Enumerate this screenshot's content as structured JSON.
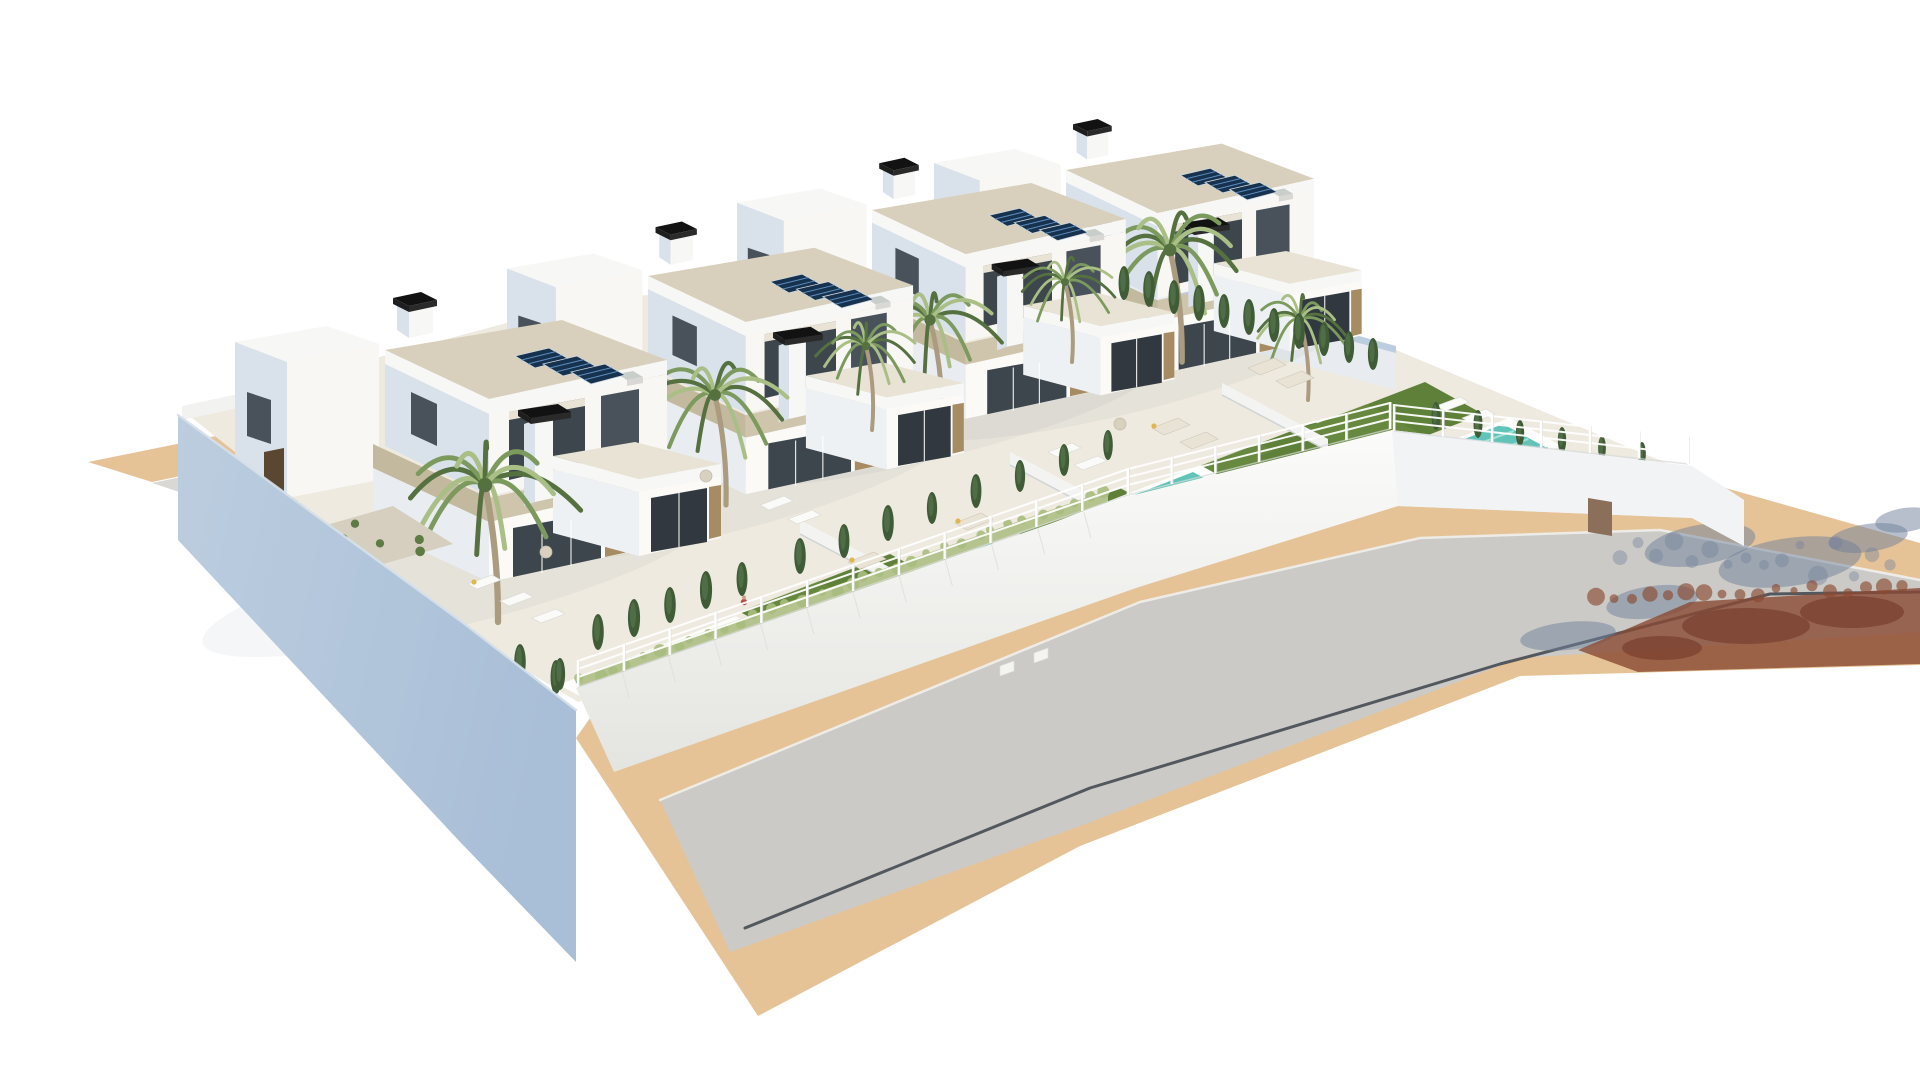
{
  "image": {
    "type": "3d-architectural-render",
    "subject": "Aerial 3D rendering of a row of four modern white two-storey villas with travertine accents, rooftop solar panels, black chimney caps, palm trees, private turquoise pools, green lawns, white perimeter walls with railing fences, and a curving grey road with sand-coloured sidewalks on a pure white background",
    "background": "#ffffff"
  },
  "palette": {
    "white_face": "#f8f7f4",
    "white_face2": "#fbfaf7",
    "face_shadow": "#d9e1eb",
    "face_shadow2": "#e9edf2",
    "face_soft": "#eef1f4",
    "roof_deck": "#d8d0bc",
    "roof_deck2": "#e8e3d5",
    "fascia": "#f7f7f5",
    "stone": "#cfc5ac",
    "stone_dark": "#c3b99f",
    "glass": "#3d454d",
    "glass_dark": "#31383f",
    "glass_win": "#49525b",
    "wood": "#a78c63",
    "wood_dark": "#5a4631",
    "solar": "#16324f",
    "solar_line": "#5d8cbd",
    "chimney": "#121212",
    "chimney_s1": "#1e1e1e",
    "chimney_s2": "#2a2a2a",
    "pool_water": "#62c4b8",
    "pool_light": "#aee8de",
    "pool_deep": "#37968c",
    "coping": "#fdfdfb",
    "lawn": "#5e8038",
    "lawn_light": "#739449",
    "palm_dark": "#55713f",
    "palm_mid": "#7c9a5e",
    "palm_light": "#a9bf85",
    "trunk": "#ab9c80",
    "cypress": "#3f5c37",
    "cypress_light": "#54734a",
    "hedge": "#b5c48e",
    "hedge_dot": "#a9bd7e",
    "shrub": "#5d7c44",
    "plot": "#efeae0",
    "gravel": "#d6cfc0",
    "road": "#cbcac7",
    "pavement": "#e5c397",
    "sidewalk_gray": "#d9d8d4",
    "driveway": "#5f6f88",
    "curb_brown": "#8f5138",
    "wall_blue": "#a9bfd7",
    "wall_blue_light": "#bccddf",
    "wall_inner": "#e8ecf0",
    "wall_white": "#f2f3f1",
    "wall_right": "#f1f3f5",
    "slate_shadow": "#70809a",
    "red_shadow": "#8a4a33",
    "red_shadow_dark": "#6f3424",
    "curb_line": "#3e444b",
    "fence": "#ffffff",
    "fence_shade": "#d7dadc",
    "ac_unit": "#c9cecb",
    "furn": "#e9e3d5",
    "furn_white": "#fafaf8",
    "pillow": "#e0b64f",
    "person_body": "#b05046",
    "person_skin": "#caa08a",
    "slat_fence": "#44352a",
    "slat_line": "#5d4936",
    "table": "#d8d1c0"
  },
  "scene": {
    "ground": {
      "tan_strip": [
        [
          88,
          462
        ],
        [
          640,
          350
        ],
        [
          708,
          366
        ],
        [
          152,
          482
        ]
      ],
      "gray_strip": [
        [
          152,
          483
        ],
        [
          708,
          367
        ],
        [
          764,
          384
        ],
        [
          210,
          502
        ]
      ],
      "driveway": [
        [
          210,
          503
        ],
        [
          432,
          457
        ],
        [
          500,
          492
        ],
        [
          274,
          541
        ]
      ],
      "brown_strip": [
        [
          274,
          542
        ],
        [
          500,
          493
        ],
        [
          524,
          507
        ],
        [
          297,
          557
        ]
      ],
      "pavement": [
        [
          590,
          718
        ],
        [
          1130,
          528
        ],
        [
          1392,
          458
        ],
        [
          1690,
          478
        ],
        [
          1920,
          543
        ],
        [
          1920,
          665
        ],
        [
          1520,
          676
        ],
        [
          1080,
          846
        ],
        [
          758,
          1016
        ],
        [
          576,
          738
        ]
      ],
      "road": [
        [
          660,
          800
        ],
        [
          1140,
          602
        ],
        [
          1420,
          538
        ],
        [
          1660,
          530
        ],
        [
          1920,
          580
        ],
        [
          1920,
          632
        ],
        [
          1520,
          658
        ],
        [
          1080,
          826
        ],
        [
          730,
          952
        ]
      ],
      "plot": [
        [
          182,
          410
        ],
        [
          600,
          298
        ],
        [
          1100,
          268
        ],
        [
          1396,
          350
        ],
        [
          1700,
          477
        ],
        [
          1692,
          502
        ],
        [
          1392,
          452
        ],
        [
          1130,
          512
        ],
        [
          578,
          702
        ],
        [
          462,
          632
        ]
      ],
      "back_wall": [
        [
          1098,
          266
        ],
        [
          1396,
          346
        ],
        [
          1396,
          390
        ],
        [
          1098,
          310
        ]
      ],
      "back_wall_cap": [
        [
          1098,
          266
        ],
        [
          1396,
          346
        ],
        [
          1396,
          353
        ],
        [
          1098,
          273
        ]
      ],
      "left_small_wall": [
        [
          182,
          406
        ],
        [
          266,
          388
        ],
        [
          266,
          402
        ],
        [
          182,
          420
        ]
      ],
      "slat_fence": [
        [
          240,
          386
        ],
        [
          334,
          364
        ],
        [
          350,
          377
        ],
        [
          256,
          399
        ]
      ],
      "front_wall": [
        [
          576,
          688
        ],
        [
          1130,
          496
        ],
        [
          1392,
          430
        ],
        [
          1692,
          466
        ],
        [
          1744,
          500
        ],
        [
          1744,
          546
        ],
        [
          1692,
          518
        ],
        [
          1398,
          506
        ],
        [
          1136,
          588
        ],
        [
          614,
          772
        ]
      ],
      "right_wall_face": [
        [
          1392,
          430
        ],
        [
          1692,
          466
        ],
        [
          1744,
          500
        ],
        [
          1744,
          546
        ],
        [
          1692,
          518
        ],
        [
          1398,
          506
        ]
      ],
      "hedge": [
        [
          578,
          676
        ],
        [
          1108,
          490
        ],
        [
          1108,
          502
        ],
        [
          578,
          690
        ]
      ],
      "left_wall": [
        [
          178,
          415
        ],
        [
          462,
          622
        ],
        [
          576,
          710
        ],
        [
          576,
          962
        ],
        [
          462,
          844
        ],
        [
          178,
          540
        ]
      ],
      "wall_door": [
        [
          1588,
          498
        ],
        [
          1612,
          502
        ],
        [
          1612,
          536
        ],
        [
          1588,
          532
        ]
      ],
      "curb_line": [
        [
          745,
          928
        ],
        [
          1090,
          788
        ],
        [
          1500,
          664
        ],
        [
          1770,
          594
        ],
        [
          1920,
          592
        ]
      ],
      "road_top_line": [
        [
          660,
          800
        ],
        [
          1140,
          602
        ],
        [
          1420,
          538
        ],
        [
          1660,
          530
        ],
        [
          1920,
          580
        ]
      ]
    },
    "shadows": {
      "slate": [
        [
          1700,
          545,
          56,
          20,
          -10
        ],
        [
          1790,
          562,
          72,
          24,
          -8
        ],
        [
          1652,
          602,
          46,
          16,
          -8
        ],
        [
          1868,
          538,
          40,
          14,
          -8
        ],
        [
          1568,
          636,
          48,
          14,
          -6
        ],
        [
          1905,
          520,
          30,
          12,
          -8
        ]
      ],
      "red_polygon": [
        [
          1578,
          650
        ],
        [
          1690,
          602
        ],
        [
          1788,
          596
        ],
        [
          1920,
          588
        ],
        [
          1920,
          664
        ],
        [
          1638,
          672
        ]
      ],
      "red_blobs": [
        [
          1746,
          626,
          64,
          18
        ],
        [
          1852,
          612,
          52,
          16
        ],
        [
          1662,
          648,
          40,
          12
        ]
      ]
    },
    "fence": {
      "segments": [
        [
          [
            578,
            686
          ],
          [
            1128,
            494
          ]
        ],
        [
          [
            1128,
            494
          ],
          [
            1390,
            428
          ]
        ],
        [
          [
            1394,
            430
          ],
          [
            1688,
            463
          ]
        ]
      ],
      "post_spacing": 45,
      "post_height": 26
    },
    "villas": [
      {
        "id": "villa-4",
        "origin": [
          1066,
          170
        ],
        "scale": 0.88,
        "palms": [
          [
            1170,
            250,
            80,
            1182,
            362
          ],
          [
            1300,
            320,
            52,
            1308,
            400
          ]
        ]
      },
      {
        "id": "villa-3",
        "origin": [
          872,
          210
        ],
        "scale": 0.9,
        "palms": [
          [
            930,
            320,
            70,
            942,
            420
          ],
          [
            1065,
            282,
            50,
            1072,
            362
          ]
        ]
      },
      {
        "id": "villa-2",
        "origin": [
          648,
          276
        ],
        "scale": 0.94,
        "palms": [
          [
            715,
            395,
            74,
            726,
            505
          ],
          [
            866,
            346,
            54,
            872,
            430
          ]
        ]
      },
      {
        "id": "villa-1",
        "origin": [
          385,
          350
        ],
        "scale": 1.0,
        "palms": [
          [
            485,
            485,
            90,
            498,
            622
          ]
        ]
      }
    ],
    "pools": [
      {
        "id": "pool-1",
        "origin": [
          577,
          682
        ],
        "u": [
          150,
          -58
        ],
        "v": [
          52,
          28
        ]
      },
      {
        "id": "pool-2",
        "origin": [
          860,
          594
        ],
        "u": [
          140,
          -54
        ],
        "v": [
          48,
          26
        ]
      },
      {
        "id": "pool-3",
        "origin": [
          1065,
          522
        ],
        "u": [
          128,
          -50
        ],
        "v": [
          46,
          25
        ]
      },
      {
        "id": "pool-4",
        "origin": [
          1385,
          470
        ],
        "u": [
          118,
          -46
        ],
        "v": [
          44,
          24
        ]
      }
    ],
    "lawns": [
      {
        "origin": [
          740,
          612
        ],
        "u": [
          150,
          -58
        ],
        "v": [
          58,
          31
        ]
      },
      {
        "origin": [
          990,
          538
        ],
        "u": [
          130,
          -50
        ],
        "v": [
          52,
          28
        ]
      },
      {
        "origin": [
          1195,
          468
        ],
        "u": [
          120,
          -46
        ],
        "v": [
          50,
          27
        ]
      },
      {
        "origin": [
          1300,
          430
        ],
        "u": [
          125,
          -48
        ],
        "v": [
          58,
          32
        ]
      },
      {
        "origin": [
          1218,
          472
        ],
        "u": [
          70,
          -27
        ],
        "v": [
          36,
          20
        ]
      }
    ],
    "gravel": [
      {
        "origin": [
          955,
          565
        ],
        "u": [
          100,
          -39
        ],
        "v": [
          42,
          23
        ]
      },
      {
        "origin": [
          1150,
          525
        ],
        "u": [
          110,
          -43
        ],
        "v": [
          46,
          25
        ]
      },
      {
        "origin": [
          288,
          536
        ],
        "u": [
          105,
          -30
        ],
        "v": [
          60,
          38
        ]
      }
    ],
    "dividers": [
      [
        [
          800,
          520
        ],
        [
          908,
          577
        ],
        [
          908,
          591
        ],
        [
          800,
          534
        ]
      ],
      [
        [
          1010,
          452
        ],
        [
          1116,
          508
        ],
        [
          1116,
          521
        ],
        [
          1010,
          465
        ]
      ],
      [
        [
          1222,
          383
        ],
        [
          1328,
          439
        ],
        [
          1328,
          451
        ],
        [
          1222,
          395
        ]
      ]
    ],
    "cypresses": [
      [
        598,
        650,
        36
      ],
      [
        634,
        637,
        38
      ],
      [
        670,
        623,
        36
      ],
      [
        706,
        609,
        38
      ],
      [
        742,
        596,
        34
      ],
      [
        800,
        574,
        36
      ],
      [
        844,
        558,
        34
      ],
      [
        888,
        541,
        36
      ],
      [
        932,
        524,
        32
      ],
      [
        976,
        508,
        34
      ],
      [
        1020,
        492,
        32
      ],
      [
        1064,
        476,
        32
      ],
      [
        1108,
        460,
        30
      ],
      [
        262,
        556,
        40
      ],
      [
        298,
        584,
        44
      ],
      [
        330,
        600,
        46
      ],
      [
        362,
        616,
        46
      ],
      [
        396,
        633,
        44
      ],
      [
        430,
        650,
        44
      ],
      [
        464,
        666,
        40
      ],
      [
        520,
        680,
        36
      ],
      [
        556,
        694,
        34
      ],
      [
        1124,
        300,
        34
      ],
      [
        1149,
        307,
        36
      ],
      [
        1174,
        314,
        34
      ],
      [
        1199,
        321,
        36
      ],
      [
        1224,
        328,
        34
      ],
      [
        1249,
        335,
        36
      ],
      [
        1274,
        342,
        34
      ],
      [
        1299,
        349,
        36
      ],
      [
        1324,
        356,
        34
      ],
      [
        1349,
        363,
        32
      ],
      [
        1373,
        370,
        32
      ],
      [
        1436,
        430,
        28
      ],
      [
        1478,
        438,
        28
      ],
      [
        1520,
        446,
        26
      ],
      [
        1562,
        453,
        26
      ],
      [
        1602,
        460,
        24
      ],
      [
        1642,
        466,
        24
      ],
      [
        1398,
        488,
        30
      ],
      [
        1428,
        502,
        28
      ],
      [
        560,
        690,
        32
      ],
      [
        594,
        706,
        30
      ]
    ],
    "furniture": {
      "loungers": [
        [
          468,
          584
        ],
        [
          500,
          601
        ],
        [
          532,
          618
        ],
        [
          760,
          505
        ],
        [
          788,
          519
        ],
        [
          1048,
          452
        ],
        [
          1074,
          465
        ],
        [
          1436,
          406
        ],
        [
          1462,
          418
        ]
      ],
      "sofas": [
        [
          848,
          562
        ],
        [
          880,
          577
        ],
        [
          955,
          523
        ],
        [
          982,
          537
        ],
        [
          1152,
          428
        ],
        [
          1180,
          442
        ],
        [
          1248,
          368
        ],
        [
          1276,
          381
        ]
      ],
      "tables": [
        [
          546,
          552
        ],
        [
          706,
          476
        ],
        [
          1120,
          424
        ]
      ],
      "pillows": [
        [
          852,
          560
        ],
        [
          958,
          521
        ],
        [
          1154,
          426
        ],
        [
          474,
          582
        ]
      ],
      "person": [
        744,
        602
      ]
    },
    "wood_panel": [
      [
        264,
        452
      ],
      [
        284,
        448
      ],
      [
        284,
        492
      ],
      [
        264,
        496
      ]
    ],
    "meter_boxes": [
      [
        1000,
        666
      ],
      [
        1034,
        653
      ]
    ]
  }
}
